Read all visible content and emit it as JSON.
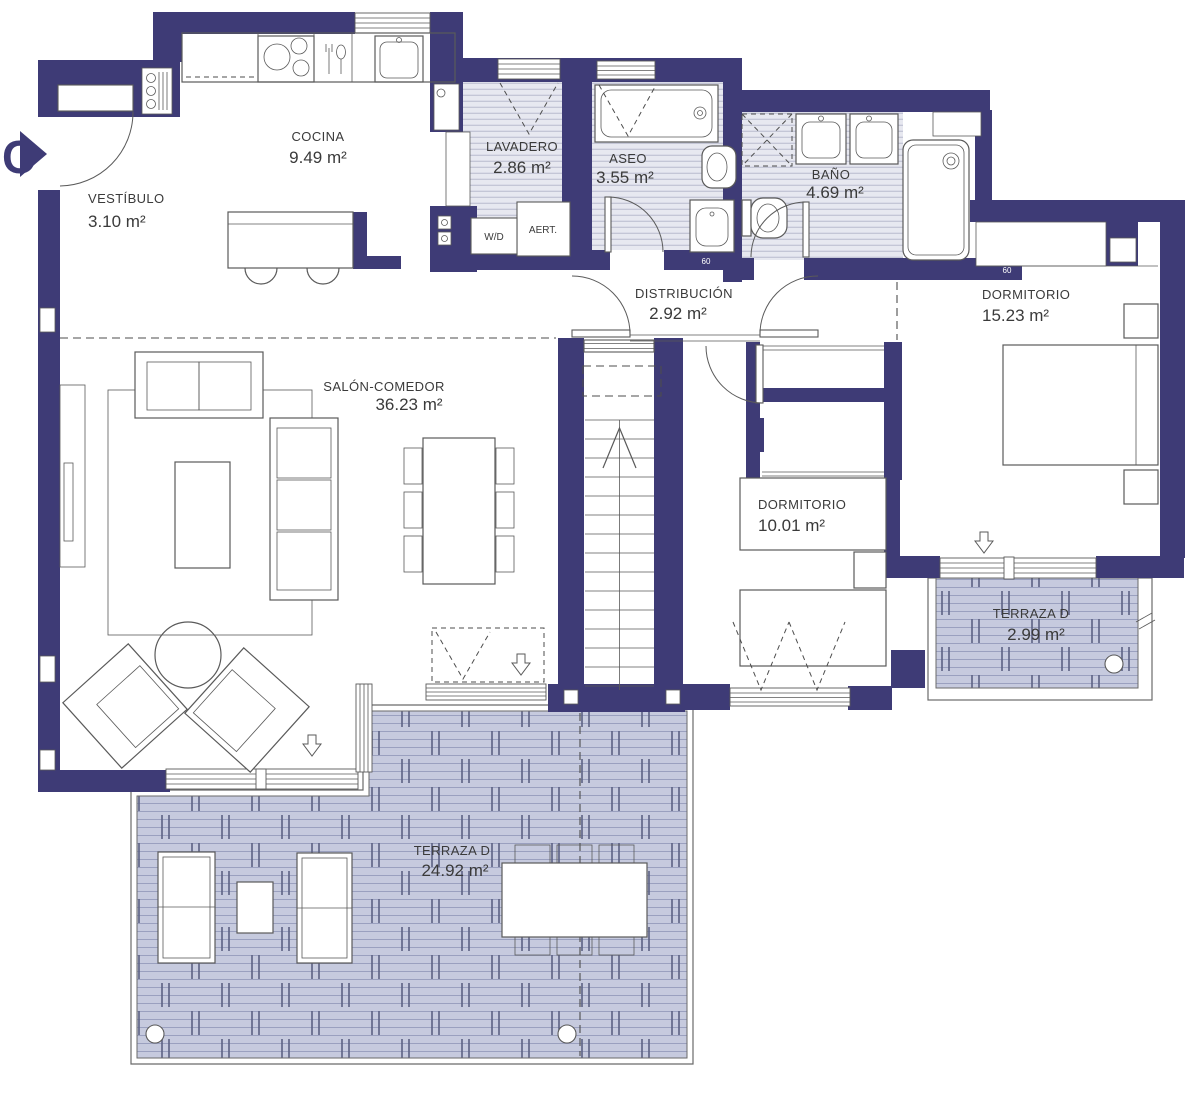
{
  "plan": {
    "entrance_label": "C",
    "door_width_labels": [
      "60",
      "60"
    ]
  },
  "rooms": {
    "vestibulo": {
      "name": "VESTÍBULO",
      "area": "3.10 m²"
    },
    "cocina": {
      "name": "COCINA",
      "area": "9.49 m²"
    },
    "lavadero": {
      "name": "LAVADERO",
      "area": "2.86 m²"
    },
    "aseo": {
      "name": "ASEO",
      "area": "3.55 m²"
    },
    "bano": {
      "name": "BAÑO",
      "area": "4.69 m²"
    },
    "distribucion": {
      "name": "DISTRIBUCIÓN",
      "area": "2.92 m²"
    },
    "dormitorio_principal": {
      "name": "DORMITORIO",
      "area": "15.23 m²"
    },
    "salon_comedor": {
      "name": "SALÓN-COMEDOR",
      "area": "36.23 m²"
    },
    "dormitorio_secundario": {
      "name": "DORMITORIO",
      "area": "10.01 m²"
    },
    "terraza_pequena": {
      "name": "TERRAZA D",
      "area": "2.99 m²"
    },
    "terraza_grande": {
      "name": "TERRAZA D",
      "area": "24.92 m²"
    }
  },
  "appliances": {
    "washer_dryer": "W/D",
    "vent": "AERT."
  },
  "colors": {
    "wall": "#3e3b76",
    "outline": "#5a5a5a",
    "dash": "#4d4d4d",
    "label": "#3a3a3a",
    "deck_fill": "#c6cade",
    "deck_line": "#9aa0bf",
    "deck_tick": "#5c6183",
    "tile_fill": "#e7e8f0",
    "tile_line": "#b8bbce"
  }
}
